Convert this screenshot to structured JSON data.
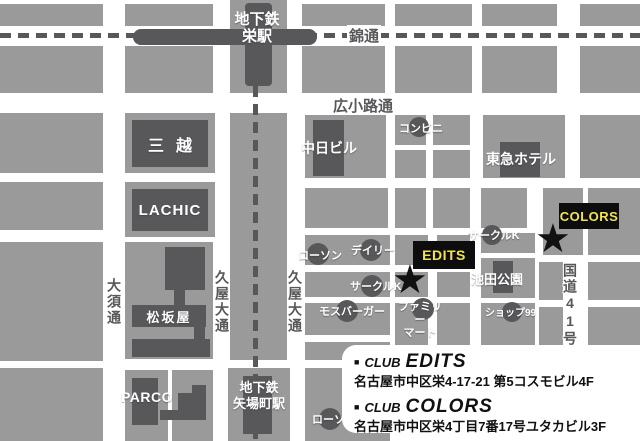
{
  "colors": {
    "block_grey": "#9a9a9a",
    "dark_grey": "#58585b",
    "venue_tag_bg": "#0d0d0d",
    "venue_tag_text": "#f2e44c",
    "star_black": "#121212"
  },
  "streets": {
    "nishiki": "錦通",
    "hirokoji": "広小路通",
    "osu": "大須通",
    "hisaya_west": "久屋大通",
    "hisaya_east": "久屋大通",
    "route41": "国道41号"
  },
  "stations": {
    "sakae": "地下鉄\n栄駅",
    "yabacho": "地下鉄\n矢場町駅"
  },
  "landmarks": {
    "mitsukoshi": "三越",
    "lachic": "LACHIC",
    "matsuzakaya": "松坂屋",
    "parco": "PARCO",
    "chunichi_bldg": "中日ビル",
    "conbini": "コンビニ",
    "tokyu_hotel": "東急ホテル",
    "lawson": "ローソン",
    "lawson_south": "ローソン",
    "daily": "デイリー",
    "circle_k_west": "サークルK",
    "circle_k_east": "サークルK",
    "mos_burger": "モスバーガー",
    "family_mart": "ファミリー\nマート",
    "ikeda_park": "池田公園",
    "shop99": "ショップ99"
  },
  "venues": {
    "edits_tag": "EDITS",
    "colors_tag": "COLORS",
    "star_glyph": "★"
  },
  "info_box": {
    "bullet": "■",
    "club_prefix": "CLUB",
    "edits": {
      "name": "EDITS",
      "address": "名古屋市中区栄4-17-21 第5コスモビル4F"
    },
    "colors": {
      "name": "COLORS",
      "address": "名古屋市中区栄4丁目7番17号ユタカビル3F"
    }
  }
}
